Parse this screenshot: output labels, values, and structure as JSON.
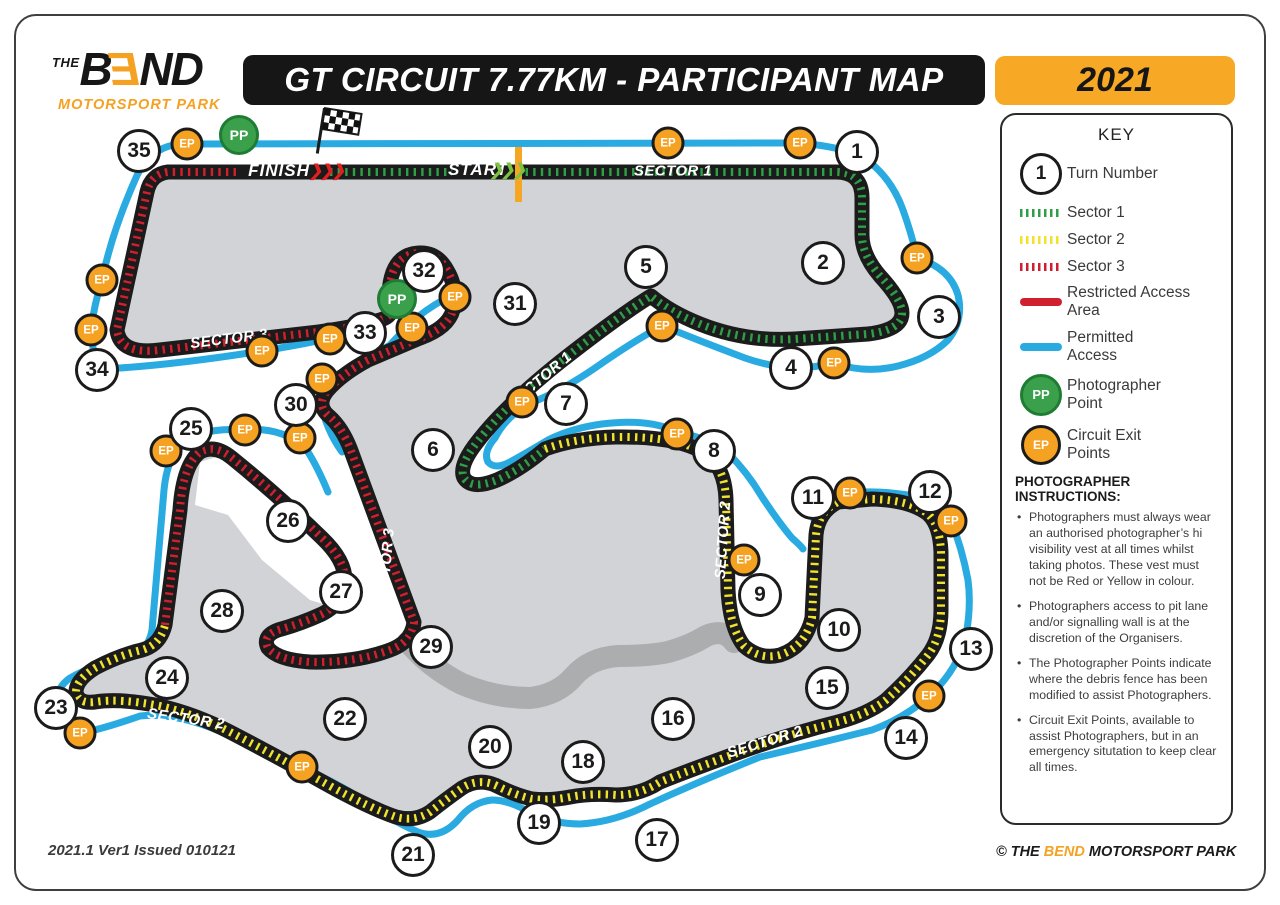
{
  "header": {
    "logo": {
      "the": "THE",
      "b": "B",
      "e": "E",
      "nd": "ND",
      "tagline": "MOTORSPORT PARK"
    },
    "title": "GT CIRCUIT 7.77KM - PARTICIPANT MAP",
    "year": "2021"
  },
  "key": {
    "title": "KEY",
    "turn_number": {
      "symbol": "1",
      "label": "Turn Number"
    },
    "sectors": [
      {
        "label": "Sector 1",
        "color": "#2f9e48"
      },
      {
        "label": "Sector 2",
        "color": "#f0e32d"
      },
      {
        "label": "Sector 3",
        "color": "#d02030"
      }
    ],
    "restricted": {
      "label": "Restricted Access Area",
      "color": "#d02030"
    },
    "permitted": {
      "label": "Permitted Access",
      "color": "#29abe2"
    },
    "pp": {
      "symbol": "PP",
      "label": "Photographer Point"
    },
    "ep": {
      "symbol": "EP",
      "label": "Circuit Exit Points"
    },
    "instructions_title": "PHOTOGRAPHER INSTRUCTIONS:",
    "instructions": [
      "Photographers must always wear an authorised photographer’s hi visibility vest at all times whilst taking photos. These vest must not be Red or Yellow in colour.",
      "Photographers access to pit lane and/or signalling wall is at the discretion of the Organisers.",
      "The Photographer Points indicate where the debris fence has been modified to assist Photographers.",
      "Circuit Exit Points, available to assist Photographers, but in an emergency situtation to keep clear all times."
    ]
  },
  "map": {
    "ep_symbol": "EP",
    "pp_symbol": "PP",
    "colors": {
      "track": "#1b1b1b",
      "infield": "#d2d3d6",
      "access_road": "#abadaf",
      "permitted": "#29abe2",
      "sector1": "#2f9e48",
      "sector2": "#f0e32d",
      "sector3": "#d02030",
      "start_line": "#f5a623"
    },
    "turns": [
      {
        "n": "1",
        "x": 857,
        "y": 152
      },
      {
        "n": "2",
        "x": 823,
        "y": 263
      },
      {
        "n": "3",
        "x": 939,
        "y": 317
      },
      {
        "n": "4",
        "x": 791,
        "y": 368
      },
      {
        "n": "5",
        "x": 646,
        "y": 267
      },
      {
        "n": "6",
        "x": 433,
        "y": 450
      },
      {
        "n": "7",
        "x": 566,
        "y": 404
      },
      {
        "n": "8",
        "x": 714,
        "y": 451
      },
      {
        "n": "9",
        "x": 760,
        "y": 595
      },
      {
        "n": "10",
        "x": 839,
        "y": 630
      },
      {
        "n": "11",
        "x": 813,
        "y": 498
      },
      {
        "n": "12",
        "x": 930,
        "y": 492
      },
      {
        "n": "13",
        "x": 971,
        "y": 649
      },
      {
        "n": "14",
        "x": 906,
        "y": 738
      },
      {
        "n": "15",
        "x": 827,
        "y": 688
      },
      {
        "n": "16",
        "x": 673,
        "y": 719
      },
      {
        "n": "17",
        "x": 657,
        "y": 840
      },
      {
        "n": "18",
        "x": 583,
        "y": 762
      },
      {
        "n": "19",
        "x": 539,
        "y": 823
      },
      {
        "n": "20",
        "x": 490,
        "y": 747
      },
      {
        "n": "21",
        "x": 413,
        "y": 855
      },
      {
        "n": "22",
        "x": 345,
        "y": 719
      },
      {
        "n": "23",
        "x": 56,
        "y": 708
      },
      {
        "n": "24",
        "x": 167,
        "y": 678
      },
      {
        "n": "25",
        "x": 191,
        "y": 429
      },
      {
        "n": "26",
        "x": 288,
        "y": 521
      },
      {
        "n": "27",
        "x": 341,
        "y": 592
      },
      {
        "n": "28",
        "x": 222,
        "y": 611
      },
      {
        "n": "29",
        "x": 431,
        "y": 647
      },
      {
        "n": "30",
        "x": 296,
        "y": 405
      },
      {
        "n": "31",
        "x": 515,
        "y": 304
      },
      {
        "n": "32",
        "x": 424,
        "y": 271
      },
      {
        "n": "33",
        "x": 365,
        "y": 333
      },
      {
        "n": "34",
        "x": 97,
        "y": 370
      },
      {
        "n": "35",
        "x": 139,
        "y": 151
      }
    ],
    "eps": [
      [
        187,
        144
      ],
      [
        668,
        143
      ],
      [
        800,
        143
      ],
      [
        917,
        258
      ],
      [
        834,
        363
      ],
      [
        662,
        326
      ],
      [
        522,
        402
      ],
      [
        677,
        434
      ],
      [
        744,
        560
      ],
      [
        850,
        493
      ],
      [
        951,
        521
      ],
      [
        929,
        696
      ],
      [
        302,
        767
      ],
      [
        80,
        733
      ],
      [
        166,
        451
      ],
      [
        245,
        430
      ],
      [
        300,
        438
      ],
      [
        322,
        379
      ],
      [
        262,
        351
      ],
      [
        330,
        339
      ],
      [
        412,
        328
      ],
      [
        455,
        297
      ],
      [
        91,
        330
      ],
      [
        102,
        280
      ]
    ],
    "pps": [
      [
        239,
        135
      ],
      [
        397,
        299
      ]
    ],
    "track_labels": [
      {
        "text": "FINISH",
        "x": 279,
        "y": 171,
        "rot": 0,
        "cls": "big",
        "name": "finish-label"
      },
      {
        "text": "❯❯❯",
        "x": 326,
        "y": 171,
        "rot": 0,
        "cls": "chev",
        "color": "#e02020",
        "name": "finish-chevrons"
      },
      {
        "text": "START",
        "x": 478,
        "y": 170,
        "rot": 0,
        "cls": "big",
        "name": "start-label"
      },
      {
        "text": "❯❯❯",
        "x": 507,
        "y": 170,
        "rot": 0,
        "cls": "chev",
        "color": "#7dc242",
        "name": "start-chevrons"
      },
      {
        "text": "SECTOR 1",
        "x": 673,
        "y": 171,
        "rot": 0,
        "name": "sector1-label"
      },
      {
        "text": "SECTOR 1",
        "x": 540,
        "y": 380,
        "rot": -40,
        "name": "sector1-label"
      },
      {
        "text": "SECTOR 2",
        "x": 723,
        "y": 540,
        "rot": -86,
        "name": "sector2-label"
      },
      {
        "text": "SECTOR 2",
        "x": 765,
        "y": 742,
        "rot": -17,
        "name": "sector2-label"
      },
      {
        "text": "SECTOR 2",
        "x": 186,
        "y": 719,
        "rot": 8,
        "name": "sector2-label"
      },
      {
        "text": "SECTOR 3",
        "x": 229,
        "y": 339,
        "rot": -7,
        "name": "sector3-label"
      },
      {
        "text": "SECTOR 3",
        "x": 386,
        "y": 567,
        "rot": -85,
        "name": "sector3-label"
      }
    ]
  },
  "footer": {
    "left": "2021.1 Ver1 Issued 010121",
    "right_pre": "© THE ",
    "right_brand": "BEND",
    "right_post": " MOTORSPORT PARK"
  }
}
